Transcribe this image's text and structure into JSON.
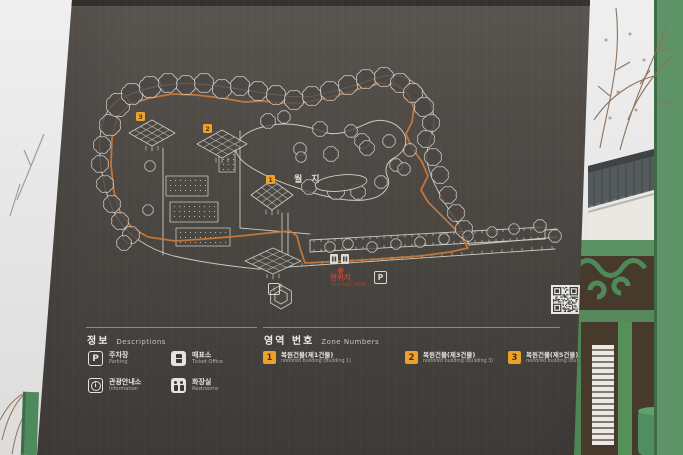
{
  "sign": {
    "map": {
      "pond_label": "월지",
      "parking_label": "P",
      "info_letter": "i",
      "you_are_here": {
        "label": "현위치",
        "sublabel": "YOU ARE HERE"
      },
      "markers": [
        {
          "number": "1"
        },
        {
          "number": "2"
        },
        {
          "number": "3"
        }
      ]
    },
    "legend": {
      "title_ko": "정보",
      "title_en": "Descriptions",
      "items": [
        {
          "name": "parking",
          "icon_letter": "P",
          "label_ko": "주차장",
          "label_en": "Parking"
        },
        {
          "name": "ticket-office",
          "label_ko": "매표소",
          "label_en": "Ticket Office"
        },
        {
          "name": "information",
          "icon_letter": "i",
          "label_ko": "관광안내소",
          "label_en": "Information"
        },
        {
          "name": "restrooms",
          "label_ko": "화장실",
          "label_en": "Restrooms"
        }
      ]
    },
    "zones": {
      "title_ko": "영역 번호",
      "title_en": "Zone Numbers",
      "items": [
        {
          "number": "1",
          "label_ko": "복원건물(제1건물)",
          "label_en": "restored building (Building 1)"
        },
        {
          "number": "2",
          "label_ko": "복원건물(제3건물)",
          "label_en": "restored building (Building 3)"
        },
        {
          "number": "3",
          "label_ko": "복원건물(제5건물)",
          "label_en": "restored building (Building 5)"
        }
      ]
    }
  },
  "colors": {
    "board": "#4a4642",
    "map_line": "#d6d2cc",
    "route_orange": "#c8793a",
    "marker_orange": "#eda22b",
    "you_are_here_red": "#b8402f",
    "fence_green": "#5d9367",
    "roof_gray": "#555a5d"
  }
}
